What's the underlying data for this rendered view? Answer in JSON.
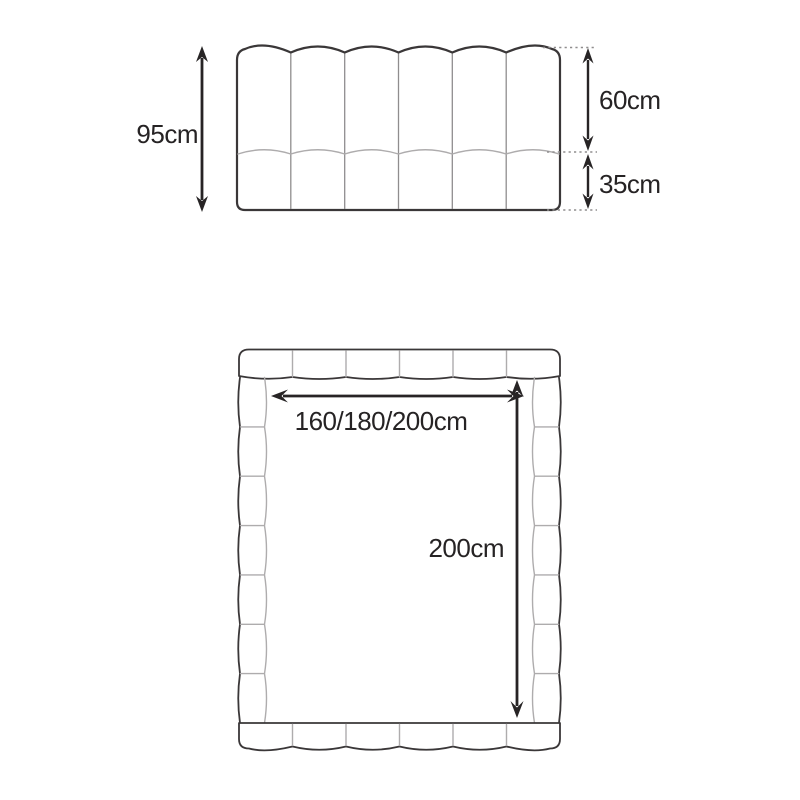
{
  "colors": {
    "background": "#ffffff",
    "line_dark": "#3a3738",
    "line_light": "#aeacad",
    "panel_line": "#8f8d8e",
    "dotted_line": "#8f8d8e",
    "dim_line": "#272425",
    "text": "#262324"
  },
  "front_view": {
    "total_height_label": "95cm",
    "upper_section_label": "60cm",
    "lower_section_label": "35cm"
  },
  "top_view": {
    "width_label": "160/180/200cm",
    "length_label": "200cm"
  }
}
